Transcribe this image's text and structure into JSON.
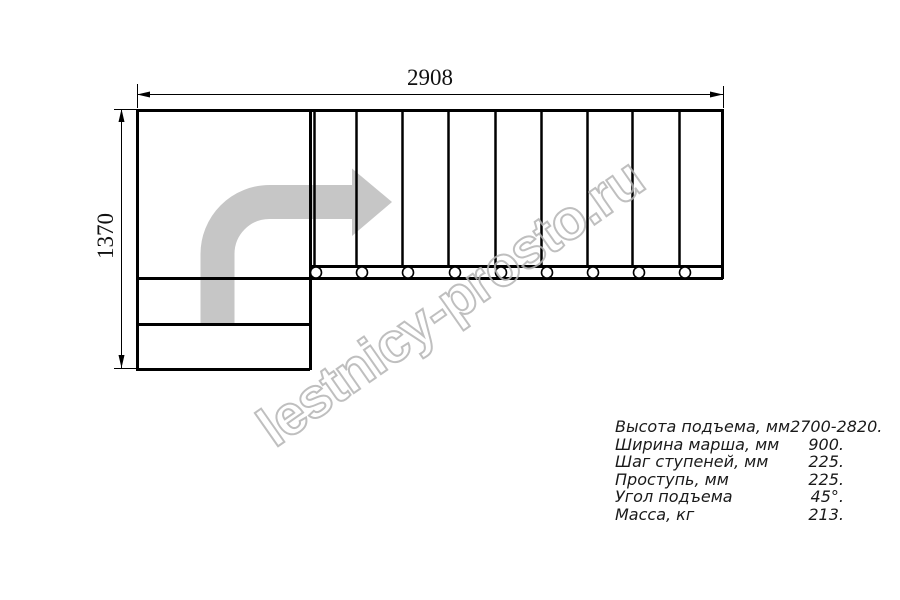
{
  "drawing": {
    "width_dim": "2908",
    "height_dim": "1370",
    "line_color": "#000000",
    "arrow_color": "#c6c6c6",
    "tread_lines_x": [
      356,
      402,
      448,
      495,
      541,
      587,
      632,
      679
    ],
    "fastener_circles_x": [
      316,
      362,
      408,
      455,
      501,
      547,
      593,
      639,
      685
    ]
  },
  "watermark": {
    "text": "lestnicy-prosto.ru",
    "color": "#b5b5b5"
  },
  "specs": {
    "rows": [
      {
        "label": "Высота подъема, мм",
        "value": "2700-2820."
      },
      {
        "label": "Ширина марша, мм",
        "value": "900."
      },
      {
        "label": "Шаг ступеней, мм",
        "value": "225."
      },
      {
        "label": "Проступь, мм",
        "value": "225."
      },
      {
        "label": "Угол подъема",
        "value": "45°."
      },
      {
        "label": "Масса, кг",
        "value": "213."
      }
    ]
  }
}
